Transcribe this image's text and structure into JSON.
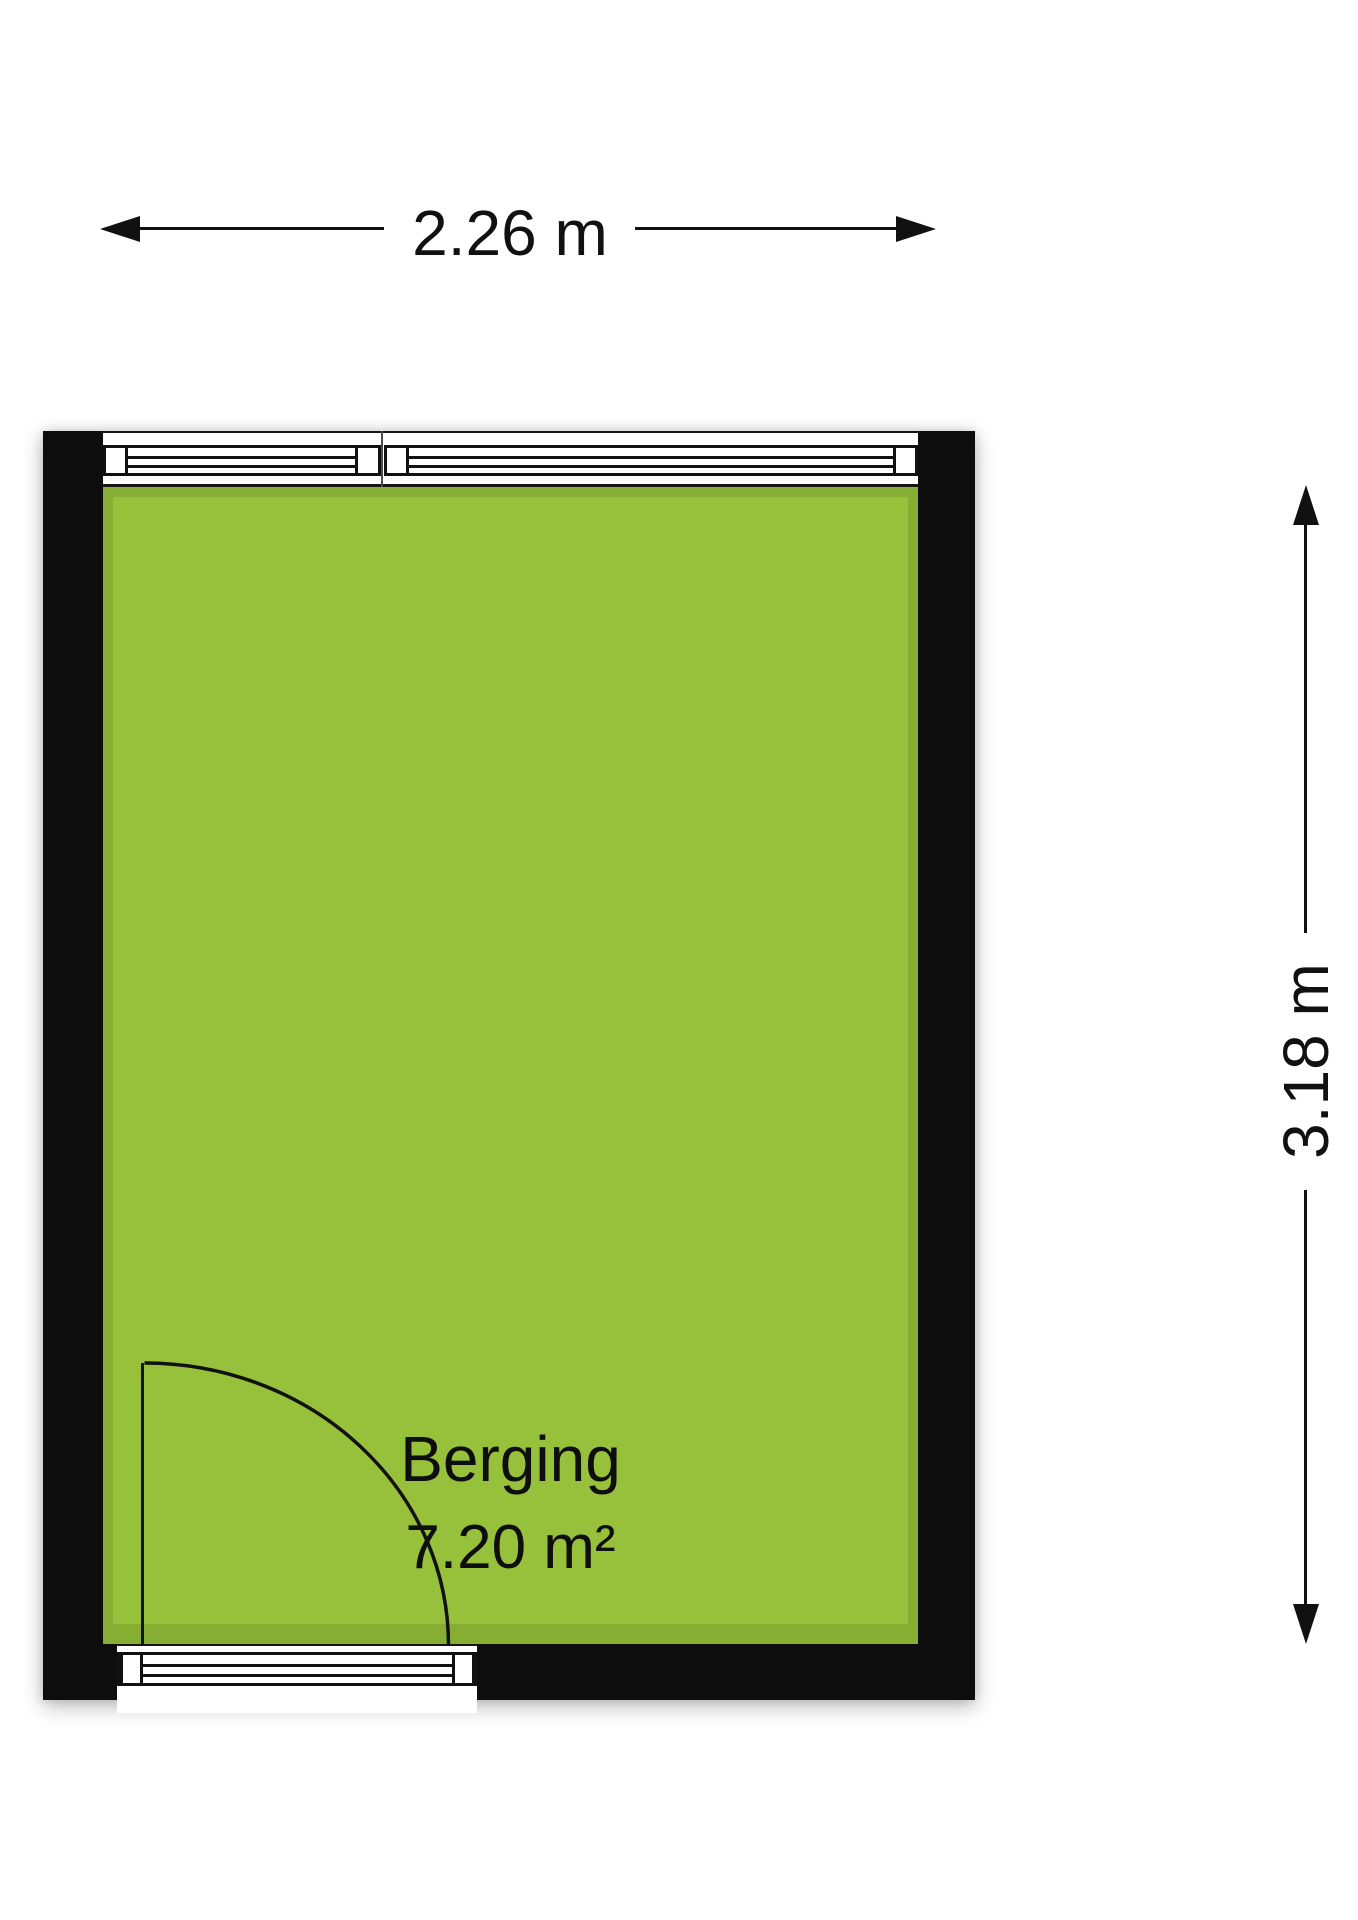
{
  "room": {
    "name": "Berging",
    "area": "7.20 m²"
  },
  "dimensions": {
    "width_label": "2.26 m",
    "height_label": "3.18 m"
  },
  "colors": {
    "floor_fill": "#97c13a",
    "floor_edge": "#86ae33",
    "wall": "#0d0d0d",
    "dimension": "#111111"
  }
}
